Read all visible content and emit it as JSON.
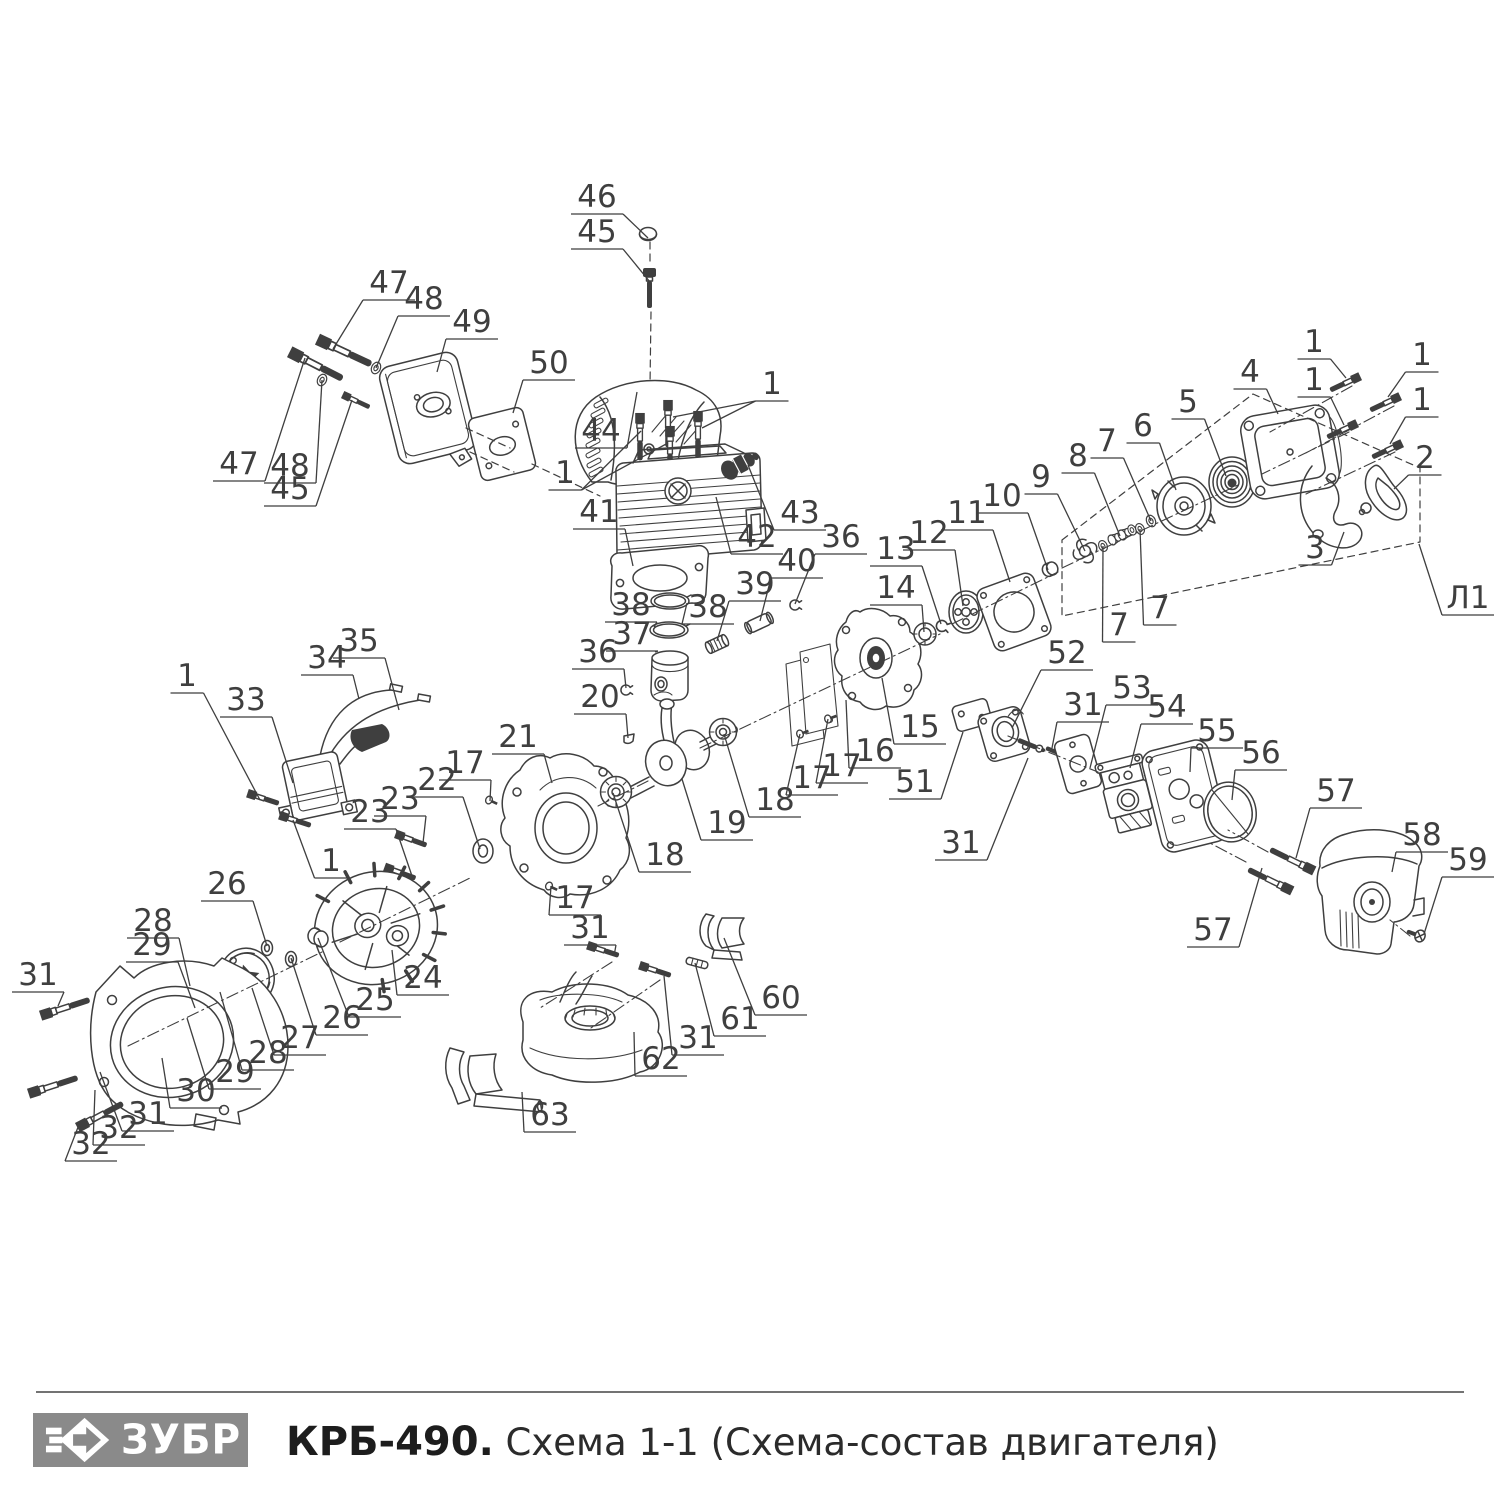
{
  "colors": {
    "line": "#3f3f3f",
    "label": "#3f3f3f",
    "logo_bg": "#8a8a8a"
  },
  "footer": {
    "logo_text": "ЗУБР",
    "title_bold": "КРБ-490.",
    "title_rest": " Схема 1-1 (Схема-состав двигателя)"
  },
  "callouts": [
    {
      "t": "46",
      "x": 597,
      "y": 197,
      "tx": 648,
      "ty": 238
    },
    {
      "t": "45",
      "x": 597,
      "y": 232,
      "tx": 650,
      "ty": 282
    },
    {
      "t": "47",
      "x": 389,
      "y": 283,
      "tx": 333,
      "ty": 349
    },
    {
      "t": "48",
      "x": 424,
      "y": 299,
      "tx": 376,
      "ty": 368
    },
    {
      "t": "49",
      "x": 472,
      "y": 322,
      "tx": 437,
      "ty": 372
    },
    {
      "t": "50",
      "x": 549,
      "y": 363,
      "tx": 513,
      "ty": 413
    },
    {
      "t": "47",
      "x": 239,
      "y": 464,
      "tx": 305,
      "ty": 358
    },
    {
      "t": "48",
      "x": 290,
      "y": 466,
      "tx": 322,
      "ty": 380
    },
    {
      "t": "45",
      "x": 290,
      "y": 489,
      "tx": 352,
      "ty": 400
    },
    {
      "t": "44",
      "x": 601,
      "y": 431,
      "tx": 637,
      "ty": 392
    },
    {
      "t": "1",
      "x": 772,
      "y": 384,
      "tx": 673,
      "ty": 417,
      "tx2": 702,
      "ty2": 428
    },
    {
      "t": "1",
      "x": 565,
      "y": 473,
      "tx": 641,
      "ty": 431,
      "tx2": 668,
      "ty2": 443
    },
    {
      "t": "41",
      "x": 599,
      "y": 512,
      "tx": 633,
      "ty": 566
    },
    {
      "t": "42",
      "x": 757,
      "y": 537,
      "tx": 716,
      "ty": 497
    },
    {
      "t": "43",
      "x": 800,
      "y": 513,
      "tx": 748,
      "ty": 465
    },
    {
      "t": "38",
      "x": 631,
      "y": 605,
      "tx": 654,
      "ty": 627
    },
    {
      "t": "38",
      "x": 708,
      "y": 607,
      "tx": 687,
      "ty": 603
    },
    {
      "t": "37",
      "x": 632,
      "y": 634,
      "tx": 655,
      "ty": 652
    },
    {
      "t": "39",
      "x": 755,
      "y": 584,
      "tx": 717,
      "ty": 641
    },
    {
      "t": "40",
      "x": 797,
      "y": 561,
      "tx": 760,
      "ty": 621
    },
    {
      "t": "36",
      "x": 841,
      "y": 537,
      "tx": 795,
      "ty": 604
    },
    {
      "t": "36",
      "x": 598,
      "y": 652,
      "tx": 626,
      "ty": 688
    },
    {
      "t": "20",
      "x": 600,
      "y": 697,
      "tx": 628,
      "ty": 738
    },
    {
      "t": "21",
      "x": 518,
      "y": 737,
      "tx": 552,
      "ty": 783
    },
    {
      "t": "22",
      "x": 437,
      "y": 780,
      "tx": 480,
      "ty": 849
    },
    {
      "t": "17",
      "x": 465,
      "y": 763,
      "tx": 490,
      "ty": 801
    },
    {
      "t": "23",
      "x": 400,
      "y": 799,
      "tx": 423,
      "ty": 843
    },
    {
      "t": "23",
      "x": 370,
      "y": 812,
      "tx": 412,
      "ty": 876
    },
    {
      "t": "1",
      "x": 187,
      "y": 676,
      "tx": 260,
      "ty": 800
    },
    {
      "t": "33",
      "x": 246,
      "y": 700,
      "tx": 293,
      "ty": 783
    },
    {
      "t": "34",
      "x": 327,
      "y": 658,
      "tx": 359,
      "ty": 699
    },
    {
      "t": "35",
      "x": 359,
      "y": 641,
      "tx": 399,
      "ty": 710
    },
    {
      "t": "1",
      "x": 331,
      "y": 861,
      "tx": 293,
      "ty": 820
    },
    {
      "t": "26",
      "x": 227,
      "y": 884,
      "tx": 267,
      "ty": 946
    },
    {
      "t": "28",
      "x": 153,
      "y": 921,
      "tx": 190,
      "ty": 986
    },
    {
      "t": "29",
      "x": 152,
      "y": 945,
      "tx": 195,
      "ty": 1008
    },
    {
      "t": "31",
      "x": 38,
      "y": 975,
      "tx": 58,
      "ty": 1006
    },
    {
      "t": "24",
      "x": 423,
      "y": 978,
      "tx": 392,
      "ty": 950
    },
    {
      "t": "25",
      "x": 375,
      "y": 1000,
      "tx": 318,
      "ty": 938
    },
    {
      "t": "26",
      "x": 342,
      "y": 1018,
      "tx": 291,
      "ty": 958
    },
    {
      "t": "27",
      "x": 300,
      "y": 1038,
      "tx": 252,
      "ty": 988
    },
    {
      "t": "28",
      "x": 268,
      "y": 1053,
      "tx": 220,
      "ty": 992
    },
    {
      "t": "29",
      "x": 235,
      "y": 1072,
      "tx": 187,
      "ty": 1018
    },
    {
      "t": "30",
      "x": 196,
      "y": 1091,
      "tx": 162,
      "ty": 1058
    },
    {
      "t": "31",
      "x": 148,
      "y": 1114,
      "tx": 100,
      "ty": 1072
    },
    {
      "t": "32",
      "x": 119,
      "y": 1128,
      "tx": 95,
      "ty": 1090
    },
    {
      "t": "32",
      "x": 91,
      "y": 1144,
      "tx": 80,
      "ty": 1122
    },
    {
      "t": "17",
      "x": 575,
      "y": 898,
      "tx": 551,
      "ty": 886
    },
    {
      "t": "18",
      "x": 665,
      "y": 855,
      "tx": 613,
      "ty": 793
    },
    {
      "t": "19",
      "x": 727,
      "y": 823,
      "tx": 682,
      "ty": 779
    },
    {
      "t": "18",
      "x": 775,
      "y": 800,
      "tx": 724,
      "ty": 734
    },
    {
      "t": "17",
      "x": 812,
      "y": 778,
      "tx": 800,
      "ty": 734
    },
    {
      "t": "17",
      "x": 842,
      "y": 766,
      "tx": 828,
      "ty": 719
    },
    {
      "t": "16",
      "x": 875,
      "y": 751,
      "tx": 846,
      "ty": 700
    },
    {
      "t": "15",
      "x": 920,
      "y": 727,
      "tx": 882,
      "ty": 678
    },
    {
      "t": "14",
      "x": 896,
      "y": 588,
      "tx": 924,
      "ty": 632
    },
    {
      "t": "13",
      "x": 896,
      "y": 549,
      "tx": 941,
      "ty": 624
    },
    {
      "t": "12",
      "x": 929,
      "y": 533,
      "tx": 963,
      "ty": 606
    },
    {
      "t": "11",
      "x": 967,
      "y": 513,
      "tx": 1010,
      "ty": 582
    },
    {
      "t": "10",
      "x": 1002,
      "y": 496,
      "tx": 1048,
      "ty": 570
    },
    {
      "t": "9",
      "x": 1041,
      "y": 477,
      "tx": 1085,
      "ty": 551
    },
    {
      "t": "8",
      "x": 1078,
      "y": 456,
      "tx": 1120,
      "ty": 536
    },
    {
      "t": "7",
      "x": 1107,
      "y": 441,
      "tx": 1151,
      "ty": 521
    },
    {
      "t": "6",
      "x": 1143,
      "y": 426,
      "tx": 1176,
      "ty": 490
    },
    {
      "t": "5",
      "x": 1188,
      "y": 402,
      "tx": 1226,
      "ty": 476
    },
    {
      "t": "4",
      "x": 1250,
      "y": 372,
      "tx": 1278,
      "ty": 414
    },
    {
      "t": "1",
      "x": 1314,
      "y": 342,
      "tx": 1346,
      "ty": 378
    },
    {
      "t": "1",
      "x": 1422,
      "y": 355,
      "tx": 1388,
      "ty": 397
    },
    {
      "t": "1",
      "x": 1314,
      "y": 380,
      "tx": 1344,
      "ty": 425
    },
    {
      "t": "1",
      "x": 1422,
      "y": 400,
      "tx": 1390,
      "ty": 444
    },
    {
      "t": "2",
      "x": 1425,
      "y": 458,
      "tx": 1394,
      "ty": 489
    },
    {
      "t": "3",
      "x": 1315,
      "y": 548,
      "tx": 1344,
      "ty": 532
    },
    {
      "t": "7",
      "x": 1160,
      "y": 608,
      "tx": 1140,
      "ty": 529
    },
    {
      "t": "7",
      "x": 1119,
      "y": 625,
      "tx": 1103,
      "ty": 546
    },
    {
      "t": "Л1",
      "x": 1468,
      "y": 598,
      "tx": 1419,
      "ty": 544
    },
    {
      "t": "52",
      "x": 1067,
      "y": 653,
      "tx": 1012,
      "ty": 728
    },
    {
      "t": "51",
      "x": 915,
      "y": 782,
      "tx": 963,
      "ty": 732
    },
    {
      "t": "31",
      "x": 961,
      "y": 843,
      "tx": 1028,
      "ty": 758
    },
    {
      "t": "31",
      "x": 1083,
      "y": 705,
      "tx": 1052,
      "ty": 748
    },
    {
      "t": "53",
      "x": 1132,
      "y": 688,
      "tx": 1090,
      "ty": 768
    },
    {
      "t": "54",
      "x": 1167,
      "y": 707,
      "tx": 1130,
      "ty": 768
    },
    {
      "t": "55",
      "x": 1217,
      "y": 731,
      "tx": 1190,
      "ty": 772
    },
    {
      "t": "56",
      "x": 1261,
      "y": 753,
      "tx": 1232,
      "ty": 800
    },
    {
      "t": "57",
      "x": 1213,
      "y": 930,
      "tx": 1262,
      "ty": 868
    },
    {
      "t": "57",
      "x": 1336,
      "y": 791,
      "tx": 1296,
      "ty": 858
    },
    {
      "t": "58",
      "x": 1422,
      "y": 835,
      "tx": 1392,
      "ty": 872
    },
    {
      "t": "59",
      "x": 1468,
      "y": 860,
      "tx": 1424,
      "ty": 934
    },
    {
      "t": "31",
      "x": 590,
      "y": 928,
      "tx": 614,
      "ty": 956
    },
    {
      "t": "31",
      "x": 698,
      "y": 1038,
      "tx": 664,
      "ty": 976
    },
    {
      "t": "60",
      "x": 781,
      "y": 998,
      "tx": 724,
      "ty": 938
    },
    {
      "t": "61",
      "x": 740,
      "y": 1019,
      "tx": 695,
      "ty": 963
    },
    {
      "t": "62",
      "x": 661,
      "y": 1059,
      "tx": 634,
      "ty": 1032
    },
    {
      "t": "63",
      "x": 550,
      "y": 1115,
      "tx": 522,
      "ty": 1092
    }
  ]
}
